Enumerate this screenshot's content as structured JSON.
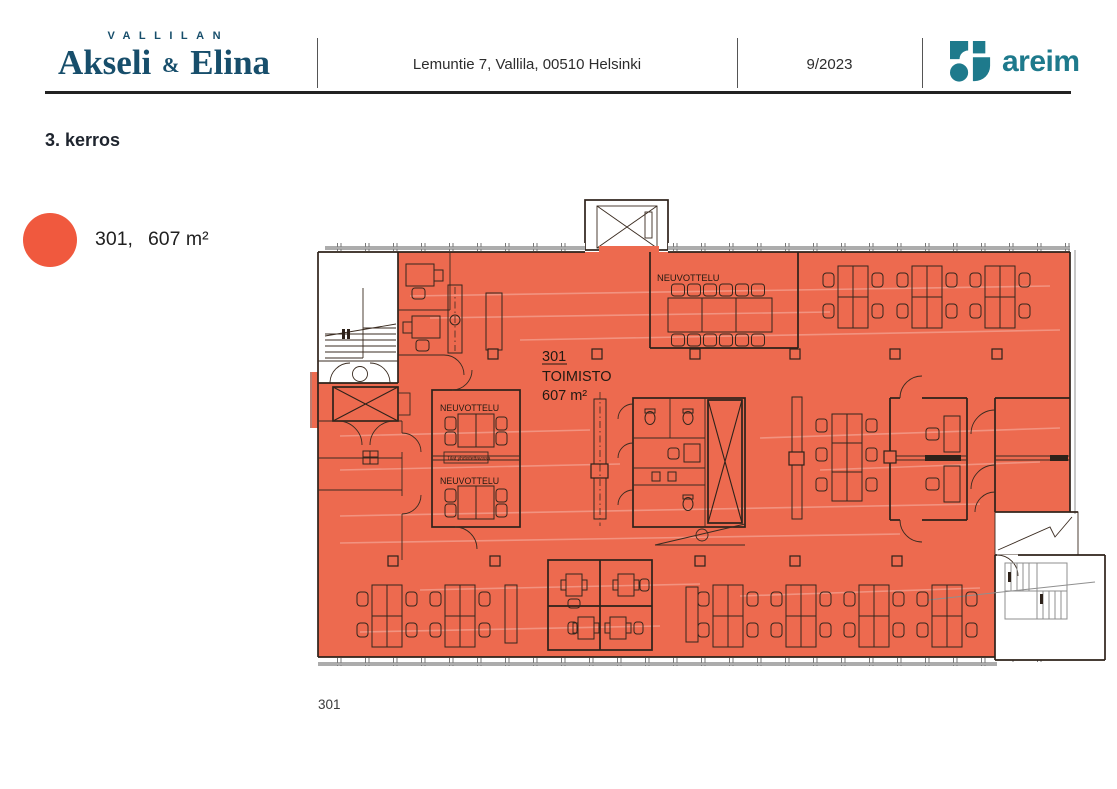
{
  "header": {
    "brand_top": "VALLILAN",
    "brand_name_1": "Akseli",
    "brand_amp": "&",
    "brand_name_2": "Elina",
    "address": "Lemuntie 7, Vallila, 00510 Helsinki",
    "date": "9/2023",
    "logo_text": "areim"
  },
  "title": "3. kerros",
  "legend": {
    "unit": "301,",
    "area": "607 m²"
  },
  "plan": {
    "unit_number": "301",
    "room_type": "TOIMISTO",
    "area": "607 m²",
    "meeting_room_label_top": "NEUVOTTELU",
    "meeting_room_label_mid_1": "NEUVOTTELU",
    "meeting_room_label_mid_2": "NEUVOTTELU",
    "combine_note": "Tilat yhdistettävissä",
    "page_number": "301"
  },
  "colors": {
    "highlight_orange": "#ED6A4F",
    "legend_dot": "#F0593E",
    "brand_navy": "#174E6B",
    "areim_teal": "#1E7A8C"
  }
}
